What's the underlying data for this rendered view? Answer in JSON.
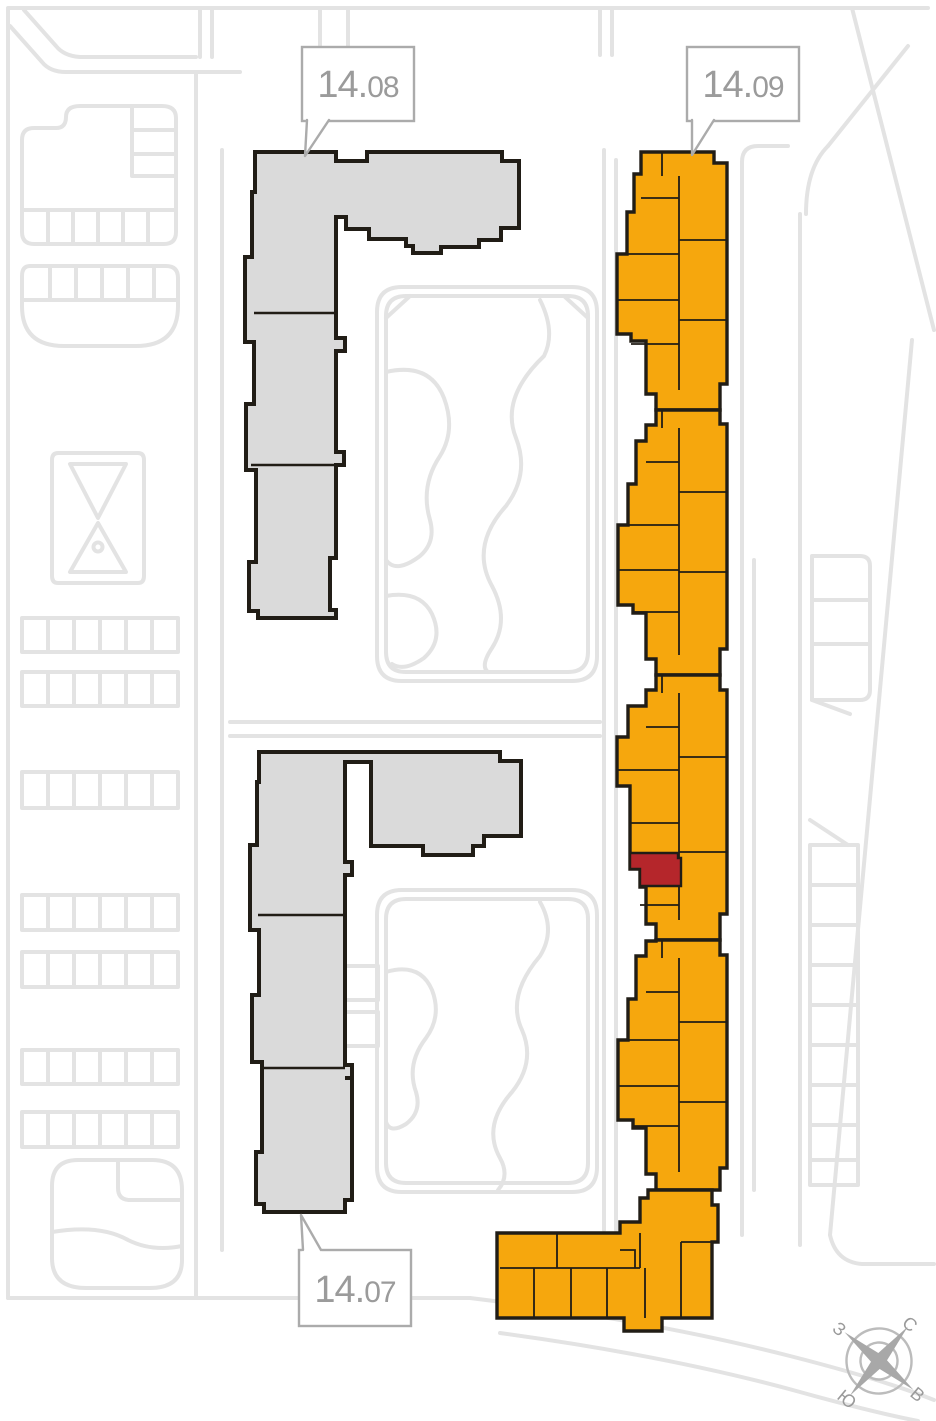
{
  "map": {
    "labels": {
      "b1408": {
        "prefix": "14.",
        "suffix": "08"
      },
      "b1409": {
        "prefix": "14.",
        "suffix": "09"
      },
      "b1407": {
        "prefix": "14.",
        "suffix": "07"
      }
    },
    "compass": {
      "north": "С",
      "east": "В",
      "south": "Ю",
      "west": "З"
    },
    "colors": {
      "background": "#ffffff",
      "highlight_building": "#f6a70d",
      "selected_unit": "#b5262b",
      "inactive_building": "#dadada",
      "building_outline": "#211d16",
      "road_line": "#e3e3e3",
      "label_text": "#9b9b9b",
      "label_border": "#ababab"
    }
  }
}
